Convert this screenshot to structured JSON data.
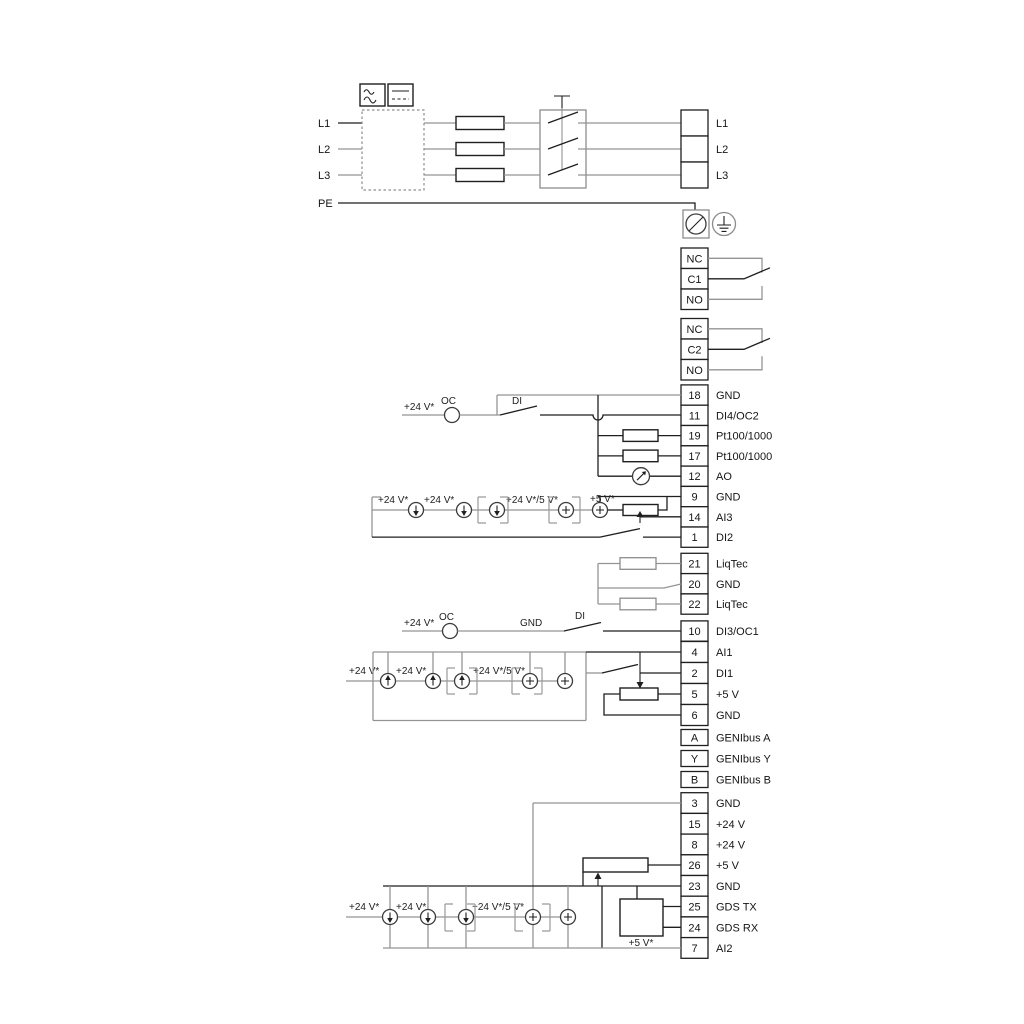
{
  "colors": {
    "wire_gray": "#949494",
    "wire_black": "#1f1f1f",
    "background": "#ffffff"
  },
  "power": {
    "l1": "L1",
    "l2": "L2",
    "l3": "L3",
    "pe": "PE",
    "out": [
      "L1",
      "L2",
      "L3"
    ]
  },
  "relay1": {
    "rows": [
      "NC",
      "C1",
      "NO"
    ]
  },
  "relay2": {
    "rows": [
      "NC",
      "C2",
      "NO"
    ]
  },
  "io1": {
    "rows": [
      {
        "num": "18",
        "label": "GND"
      },
      {
        "num": "11",
        "label": "DI4/OC2"
      },
      {
        "num": "19",
        "label": "Pt100/1000"
      },
      {
        "num": "17",
        "label": "Pt100/1000"
      },
      {
        "num": "12",
        "label": "AO"
      },
      {
        "num": "9",
        "label": "GND"
      },
      {
        "num": "14",
        "label": "AI3"
      },
      {
        "num": "1",
        "label": "DI2"
      }
    ]
  },
  "liqtec": {
    "rows": [
      {
        "num": "21",
        "label": "LiqTec"
      },
      {
        "num": "20",
        "label": "GND"
      },
      {
        "num": "22",
        "label": "LiqTec"
      }
    ]
  },
  "di3": {
    "num": "10",
    "label": "DI3/OC1"
  },
  "io2": {
    "rows": [
      {
        "num": "4",
        "label": "AI1"
      },
      {
        "num": "2",
        "label": "DI1"
      },
      {
        "num": "5",
        "label": "+5 V"
      },
      {
        "num": "6",
        "label": "GND"
      }
    ]
  },
  "genibus": {
    "rows": [
      {
        "num": "A",
        "label": "GENIbus A"
      },
      {
        "num": "Y",
        "label": "GENIbus Y"
      },
      {
        "num": "B",
        "label": "GENIbus B"
      }
    ]
  },
  "io3": {
    "rows": [
      {
        "num": "3",
        "label": "GND"
      },
      {
        "num": "15",
        "label": "+24 V"
      },
      {
        "num": "8",
        "label": "+24 V"
      },
      {
        "num": "26",
        "label": "+5 V"
      },
      {
        "num": "23",
        "label": "GND"
      },
      {
        "num": "25",
        "label": "GDS TX"
      },
      {
        "num": "24",
        "label": "GDS RX"
      },
      {
        "num": "7",
        "label": "AI2"
      }
    ]
  },
  "annotations": {
    "plus24": "+24 V*",
    "plus24or5": "+24 V*/5 V*",
    "plus5": "+5 V*",
    "oc": "OC",
    "di": "DI",
    "gnd": "GND"
  }
}
